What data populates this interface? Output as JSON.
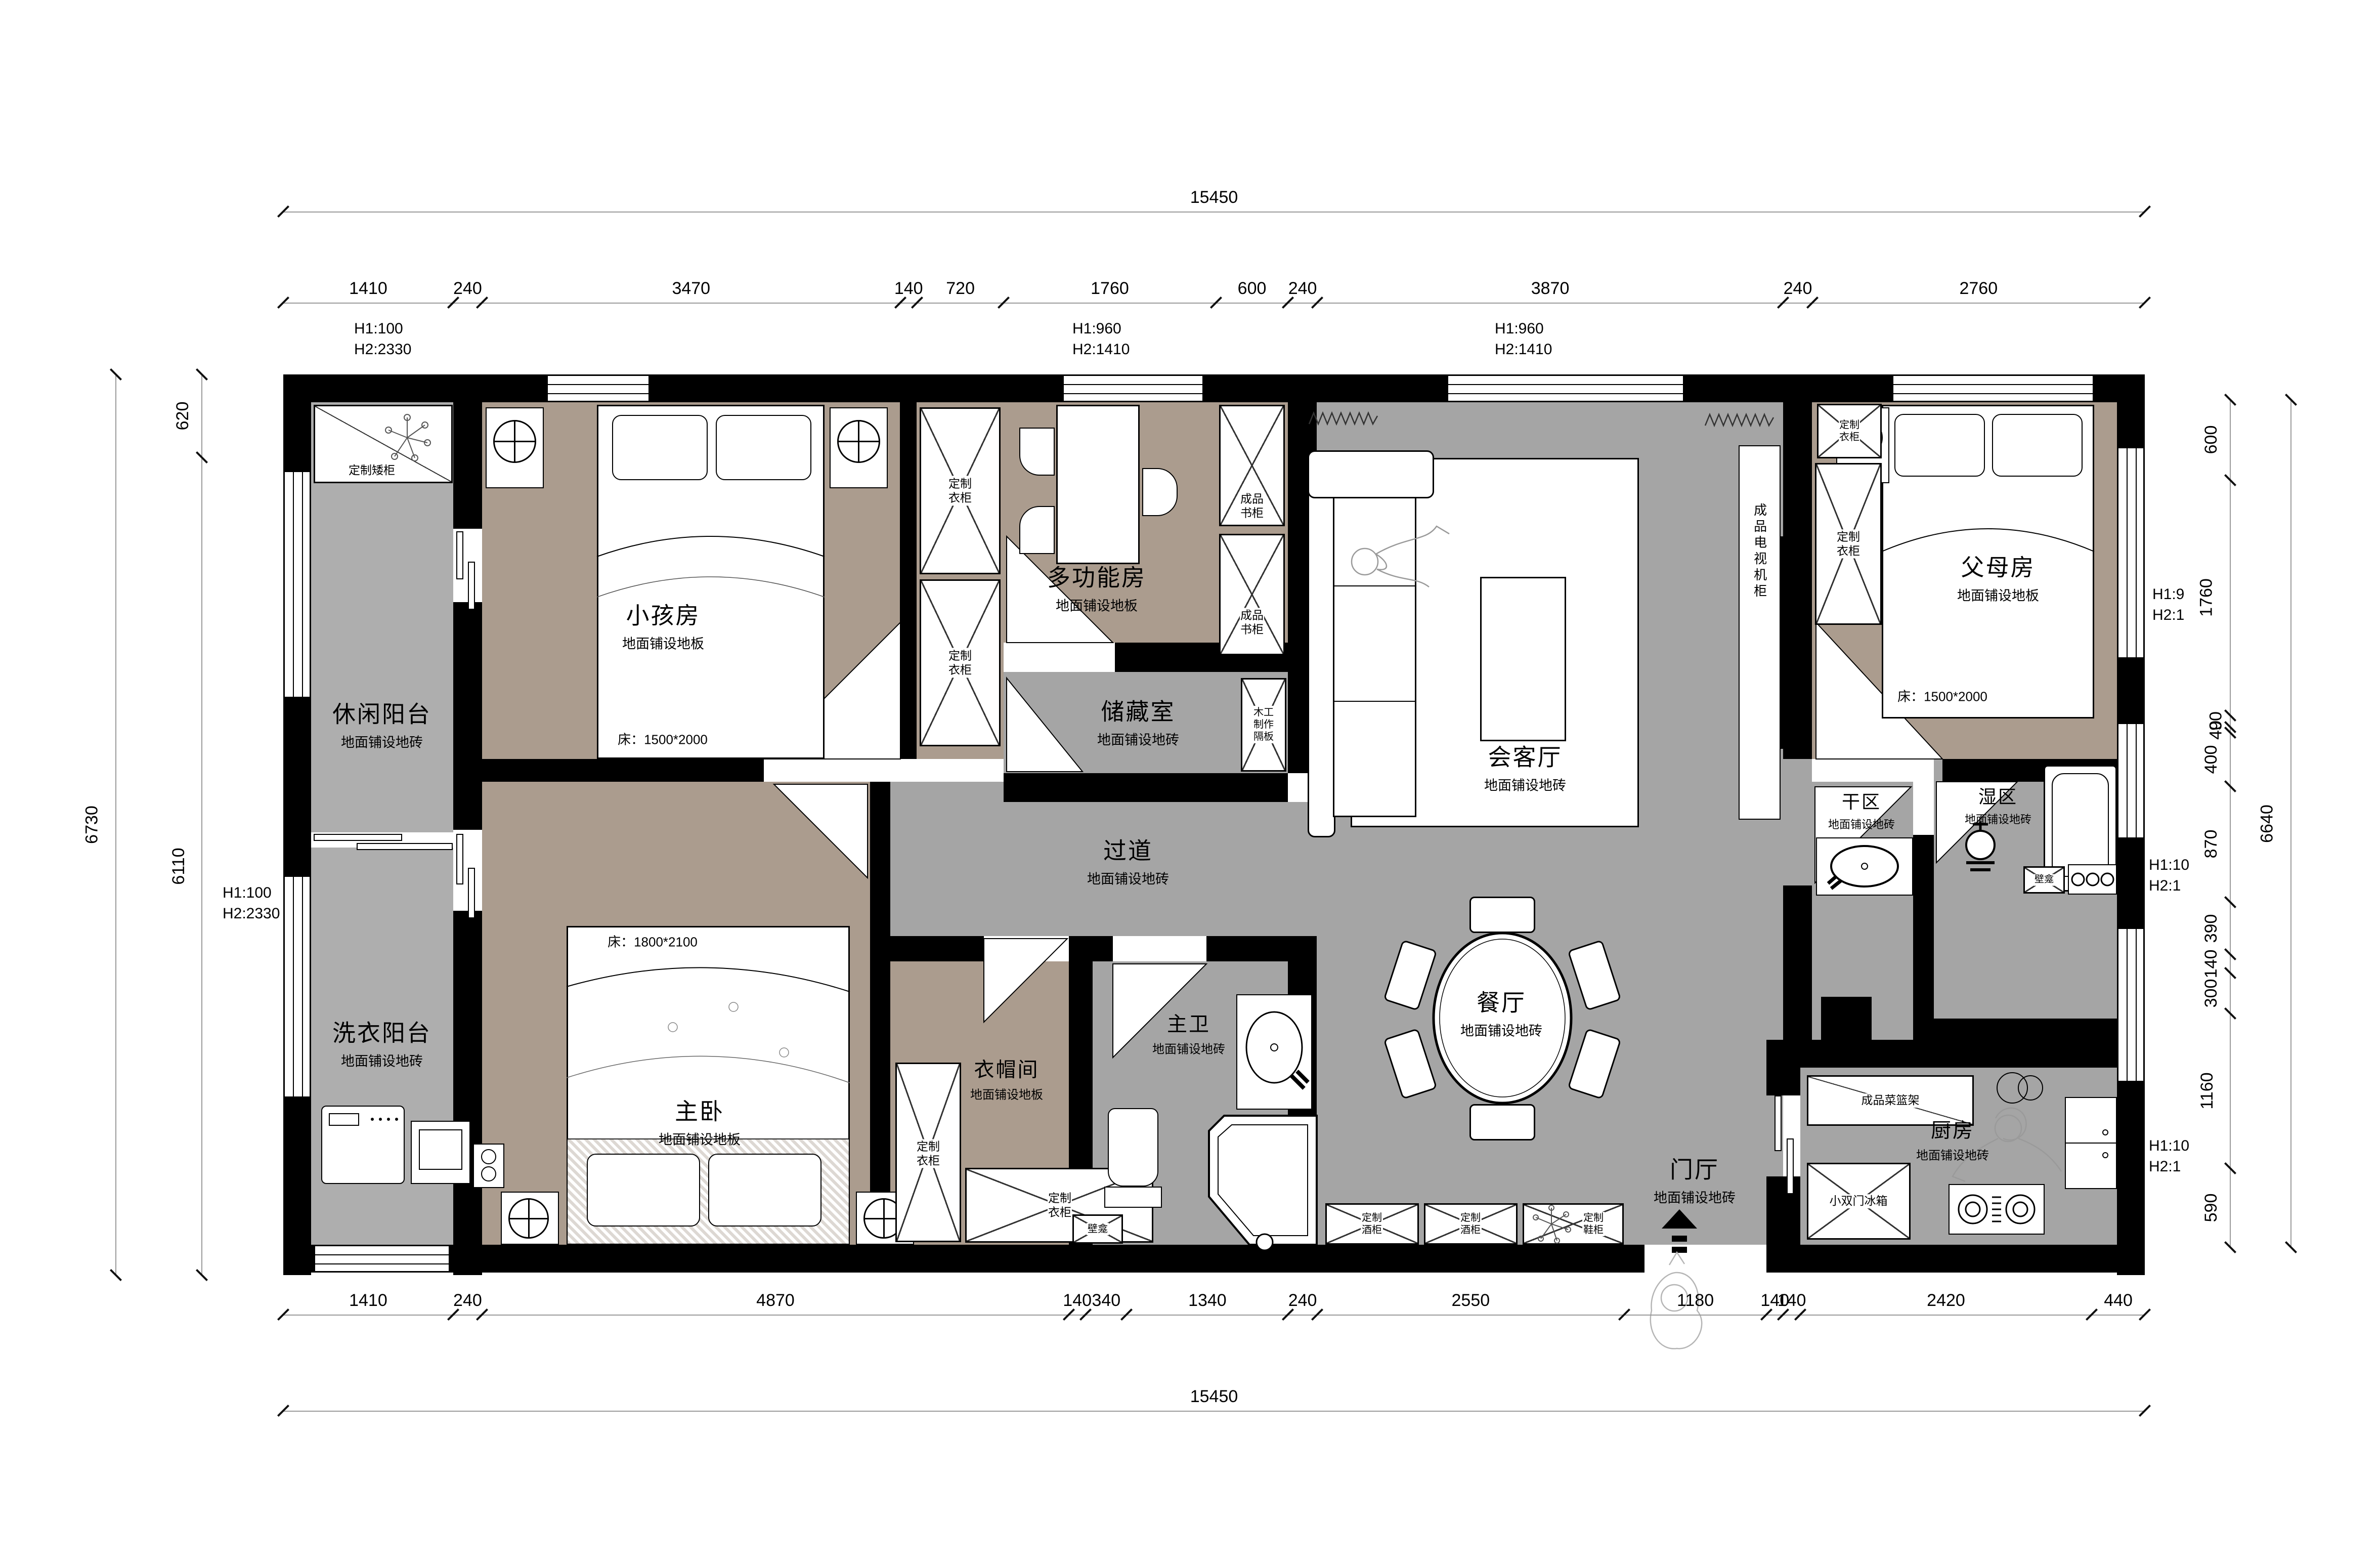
{
  "dims": {
    "top_overall": "15450",
    "bottom_overall": "15450",
    "left_overall": "6730",
    "right_overall": "6640",
    "top": [
      "1410",
      "240",
      "3470",
      "140",
      "720",
      "1760",
      "600",
      "240",
      "3870",
      "240",
      "2760"
    ],
    "bottom": [
      "1410",
      "240",
      "4870",
      "140",
      "340",
      "1340",
      "240",
      "2550",
      "1180",
      "140",
      "140",
      "2420",
      "440"
    ],
    "left": [
      "620",
      "6110"
    ],
    "right": [
      "600",
      "1760",
      "90",
      "40",
      "400",
      "870",
      "390",
      "140",
      "300",
      "1160",
      "590"
    ]
  },
  "annotations": {
    "top_left": {
      "l1": "H1:100",
      "l2": "H2:2330"
    },
    "top_mid1": {
      "l1": "H1:960",
      "l2": "H2:1410"
    },
    "top_mid2": {
      "l1": "H1:960",
      "l2": "H2:1410"
    },
    "left_mid": {
      "l1": "H1:100",
      "l2": "H2:2330"
    },
    "right_top": {
      "l1": "H1:9",
      "l2": "H2:1"
    },
    "right_mid": {
      "l1": "H1:10",
      "l2": "H2:1"
    },
    "right_bottom": {
      "l1": "H1:10",
      "l2": "H2:1"
    }
  },
  "rooms": {
    "leisure_balcony": {
      "name": "休闲阳台",
      "floor": "地面铺设地砖"
    },
    "laundry_balcony": {
      "name": "洗衣阳台",
      "floor": "地面铺设地砖"
    },
    "kids_room": {
      "name": "小孩房",
      "floor": "地面铺设地板",
      "bed": "床：1500*2000"
    },
    "multi_room": {
      "name": "多功能房",
      "floor": "地面铺设地板"
    },
    "storage": {
      "name": "储藏室",
      "floor": "地面铺设地砖"
    },
    "living": {
      "name": "会客厅",
      "floor": "地面铺设地砖"
    },
    "parents_room": {
      "name": "父母房",
      "floor": "地面铺设地板",
      "bed": "床：1500*2000"
    },
    "master_room": {
      "name": "主卧",
      "floor": "地面铺设地板",
      "bed": "床：1800*2100"
    },
    "cloakroom": {
      "name": "衣帽间",
      "floor": "地面铺设地板"
    },
    "master_bath": {
      "name": "主卫",
      "floor": "地面铺设地砖"
    },
    "hallway": {
      "name": "过道",
      "floor": "地面铺设地砖"
    },
    "dining": {
      "name": "餐厅",
      "floor": "地面铺设地砖"
    },
    "foyer": {
      "name": "门厅",
      "floor": "地面铺设地砖"
    },
    "dry_area": {
      "name": "干区",
      "floor": "地面铺设地砖"
    },
    "wet_area": {
      "name": "湿区",
      "floor": "地面铺设地砖"
    },
    "kitchen": {
      "name": "厨房",
      "floor": "地面铺设地砖"
    }
  },
  "fixtures": {
    "low_cabinet": "定制矮柜",
    "wardrobe": "定制\n衣柜",
    "bookcase": "成品\n书柜",
    "partition": "木工\n制作\n隔板",
    "tv_cabinet": "成品电视机柜",
    "wine_cabinet": "定制\n酒柜",
    "shoe_cabinet": "定制\n鞋柜",
    "basket_rack": "成品菜篮架",
    "fridge": "小双门冰箱",
    "niche": "壁龛"
  }
}
